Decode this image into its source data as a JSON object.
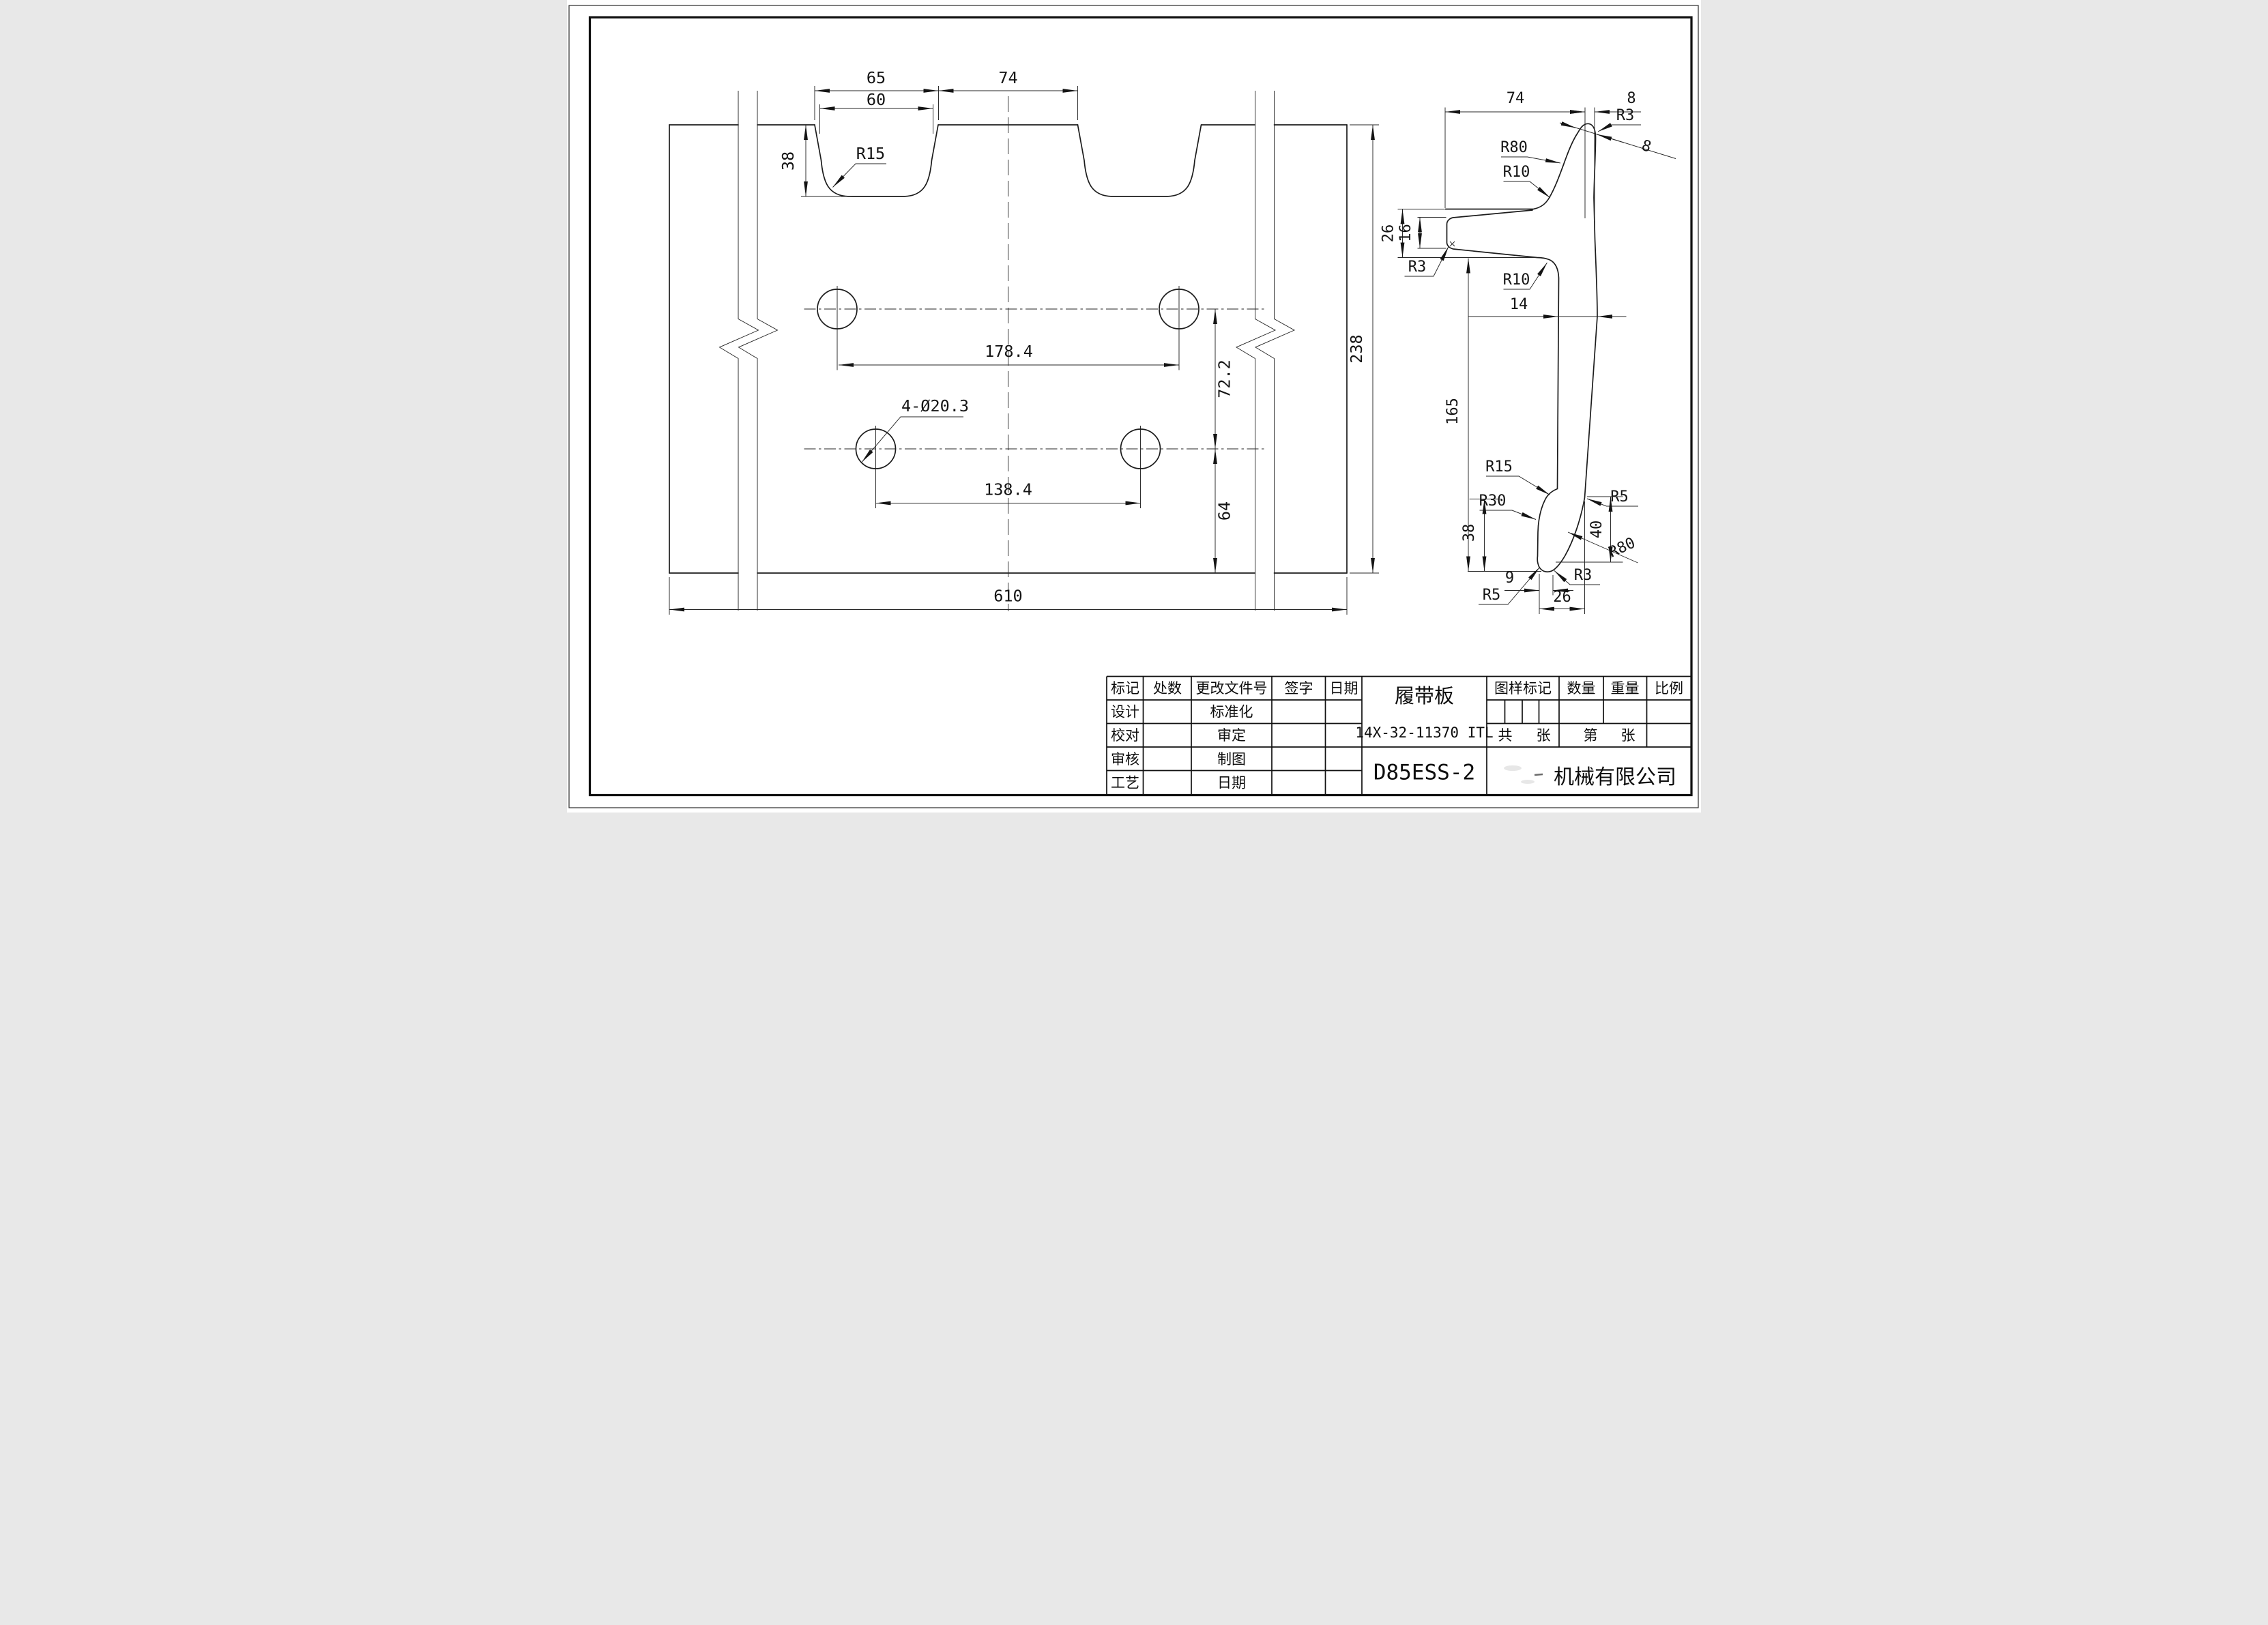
{
  "colors": {
    "paper": "#ffffff",
    "ink": "#1c1c1c"
  },
  "main_view": {
    "labels": {
      "d65": "65",
      "d60": "60",
      "d74": "74",
      "d38": "38",
      "r15": "R15",
      "d1784": "178.4",
      "d722": "72.2",
      "holes": "4-Ø20.3",
      "d1384": "138.4",
      "d64": "64",
      "d610": "610",
      "d238": "238"
    }
  },
  "section_view": {
    "labels": {
      "d74": "74",
      "d8_top": "8",
      "r3_tip": "R3",
      "d8_diag": "8",
      "r80_top": "R80",
      "r10_top": "R10",
      "d26_top": "26",
      "d16": "16",
      "r3_slot": "R3",
      "r10_mid": "R10",
      "d14": "14",
      "d165": "165",
      "r15_foot": "R15",
      "r30_foot": "R30",
      "d38_foot": "38",
      "r5_right": "R5",
      "d40": "40",
      "r80_foot": "R80",
      "d9": "9",
      "r3_foot": "R3",
      "r5_foot": "R5",
      "d26_foot": "26"
    }
  },
  "title_block": {
    "headers_left": [
      "标记",
      "处数",
      "更改文件号",
      "签字",
      "日期"
    ],
    "row_labels": [
      "设计",
      "校对",
      "审核",
      "工艺"
    ],
    "mid_labels": [
      "标准化",
      "审定",
      "制图",
      "日期"
    ],
    "part_name": "履带板",
    "part_code": "14X-32-11370 ITL",
    "model": "D85ESS-2",
    "headers_right": [
      "图样标记",
      "数量",
      "重量",
      "比例"
    ],
    "total_label": "共",
    "total_sheet": "张",
    "page_label": "第",
    "page_sheet": "张",
    "company": "机械有限公司"
  }
}
